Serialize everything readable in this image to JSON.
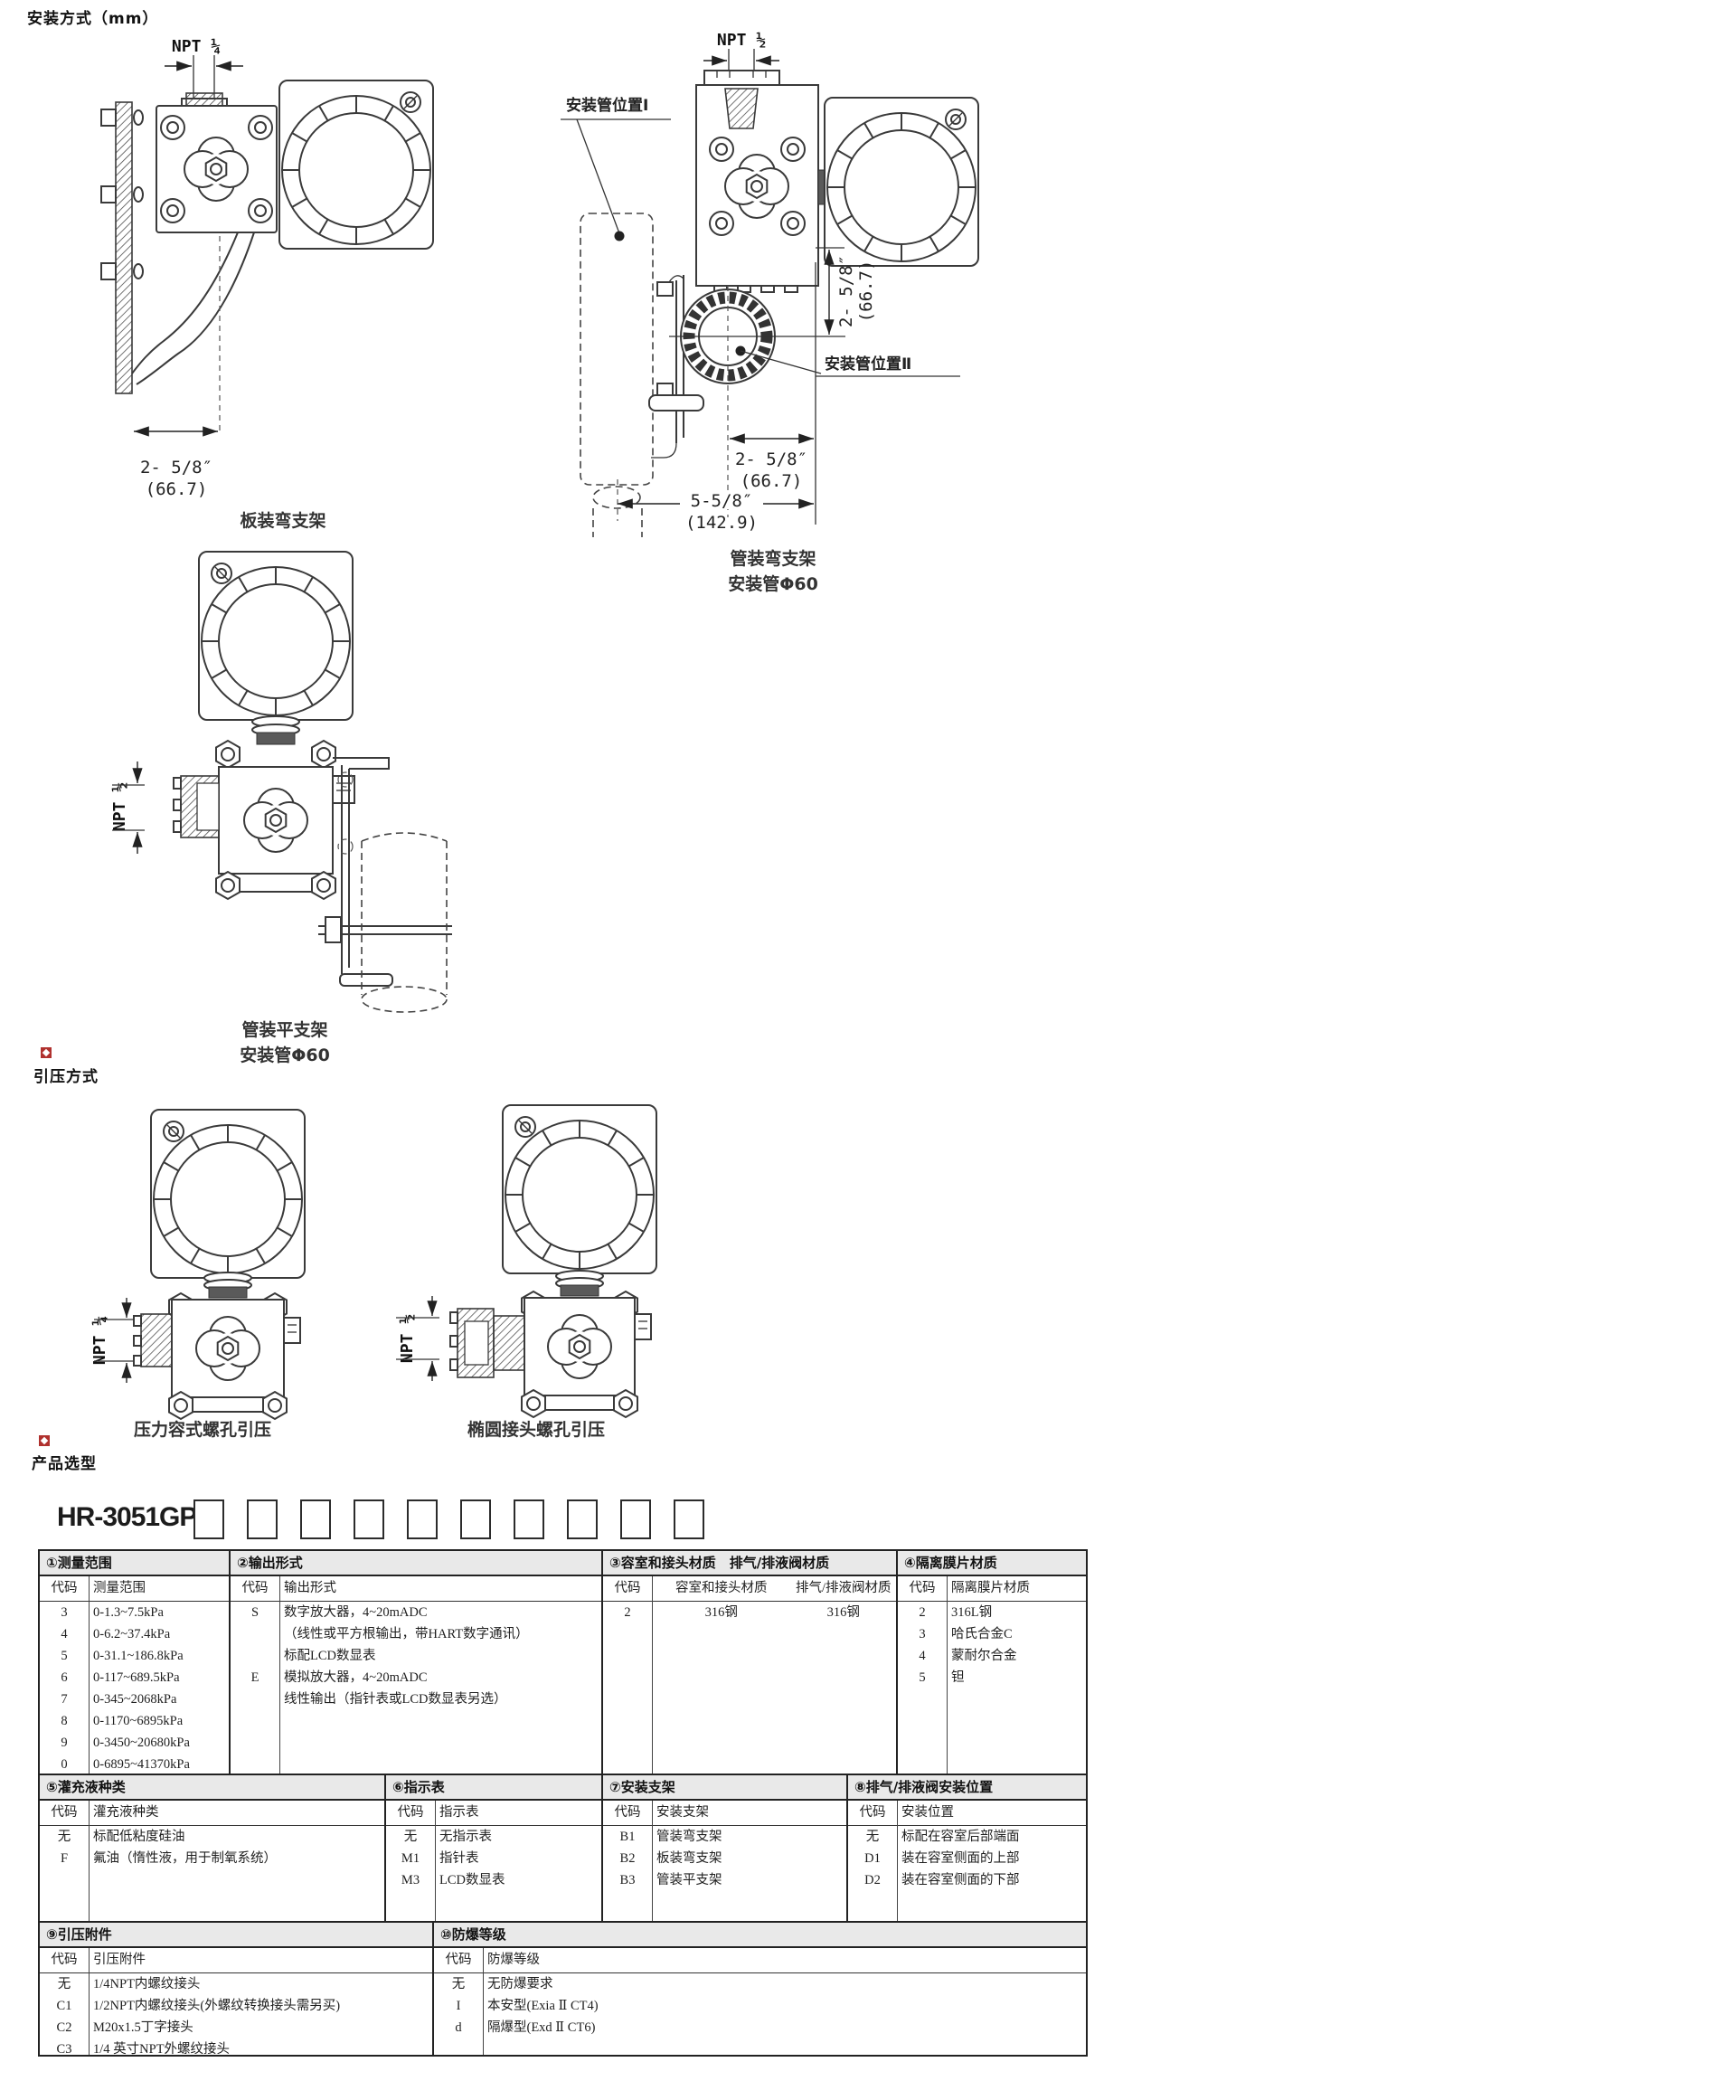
{
  "page": {
    "section1_title": "安装方式（mm）",
    "section2_title": "引压方式",
    "section3_title": "产品选型",
    "accent_red": "#b0312e",
    "line_color": "#3a3a3a"
  },
  "diagram_panel_bracket": {
    "npt": "NPT ¼",
    "dim_in": "2- 5/8″",
    "dim_mm": "(66.7)",
    "caption": "板装弯支架"
  },
  "diagram_pipe_bent": {
    "npt": "NPT ½",
    "pos1": "安装管位置Ⅰ",
    "pos2": "安装管位置Ⅱ",
    "vdim_in": "2- 5/8″",
    "vdim_mm": "(66.7)",
    "hdim1_in": "2- 5/8″",
    "hdim1_mm": "(66.7)",
    "hdim2_in": "5-5/8″",
    "hdim2_mm": "(142.9)",
    "caption1": "管装弯支架",
    "caption2": "安装管Φ60"
  },
  "diagram_pipe_flat": {
    "npt": "NPT ½",
    "caption1": "管装平支架",
    "caption2": "安装管Φ60"
  },
  "diagram_tap_left": {
    "npt": "NPT ¼",
    "caption": "压力容式螺孔引压"
  },
  "diagram_tap_right": {
    "npt": "NPT ½",
    "caption": "椭圆接头螺孔引压"
  },
  "selection": {
    "model_prefix": "HR-3051GP-",
    "positions": [
      "①",
      "②",
      "③",
      "④",
      "⑤",
      "⑥",
      "⑦",
      "⑧",
      "⑨",
      "⑩"
    ]
  },
  "tables": [
    {
      "title": "①测量范围",
      "headers": [
        "代码",
        "测量范围"
      ],
      "rows": [
        [
          "3",
          "0-1.3~7.5kPa"
        ],
        [
          "4",
          "0-6.2~37.4kPa"
        ],
        [
          "5",
          "0-31.1~186.8kPa"
        ],
        [
          "6",
          "0-117~689.5kPa"
        ],
        [
          "7",
          "0-345~2068kPa"
        ],
        [
          "8",
          "0-1170~6895kPa"
        ],
        [
          "9",
          "0-3450~20680kPa"
        ],
        [
          "0",
          "0-6895~41370kPa"
        ]
      ]
    },
    {
      "title": "②输出形式",
      "headers": [
        "代码",
        "输出形式"
      ],
      "rows": [
        [
          "S",
          "数字放大器，4~20mADC"
        ],
        [
          "",
          "（线性或平方根输出，带HART数字通讯）"
        ],
        [
          "",
          "标配LCD数显表"
        ],
        [
          "E",
          "模拟放大器，4~20mADC"
        ],
        [
          "",
          "线性输出（指针表或LCD数显表另选）"
        ]
      ]
    },
    {
      "title": "③容室和接头材质　排气/排液阀材质",
      "headers": [
        "代码",
        "容室和接头材质",
        "排气/排液阀材质"
      ],
      "rows": [
        [
          "2",
          "316钢",
          "316钢"
        ]
      ]
    },
    {
      "title": "④隔离膜片材质",
      "headers": [
        "代码",
        "隔离膜片材质"
      ],
      "rows": [
        [
          "2",
          "316L钢"
        ],
        [
          "3",
          "哈氏合金C"
        ],
        [
          "4",
          "蒙耐尔合金"
        ],
        [
          "5",
          "钽"
        ]
      ]
    },
    {
      "title": "⑤灌充液种类",
      "headers": [
        "代码",
        "灌充液种类"
      ],
      "rows": [
        [
          "无",
          "标配低粘度硅油"
        ],
        [
          "F",
          "氟油（惰性液，用于制氧系统）"
        ]
      ]
    },
    {
      "title": "⑥指示表",
      "headers": [
        "代码",
        "指示表"
      ],
      "rows": [
        [
          "无",
          "无指示表"
        ],
        [
          "M1",
          "指针表"
        ],
        [
          "M3",
          "LCD数显表"
        ]
      ]
    },
    {
      "title": "⑦安装支架",
      "headers": [
        "代码",
        "安装支架"
      ],
      "rows": [
        [
          "B1",
          "管装弯支架"
        ],
        [
          "B2",
          "板装弯支架"
        ],
        [
          "B3",
          "管装平支架"
        ]
      ]
    },
    {
      "title": "⑧排气/排液阀安装位置",
      "headers": [
        "代码",
        "安装位置"
      ],
      "rows": [
        [
          "无",
          "标配在容室后部端面"
        ],
        [
          "D1",
          "装在容室侧面的上部"
        ],
        [
          "D2",
          "装在容室侧面的下部"
        ]
      ]
    },
    {
      "title": "⑨引压附件",
      "headers": [
        "代码",
        "引压附件"
      ],
      "rows": [
        [
          "无",
          "1/4NPT内螺纹接头"
        ],
        [
          "C1",
          "1/2NPT内螺纹接头(外螺纹转换接头需另买)"
        ],
        [
          "C2",
          "M20x1.5丁字接头"
        ],
        [
          "C3",
          "1/4 英寸NPT外螺纹接头"
        ]
      ]
    },
    {
      "title": "⑩防爆等级",
      "headers": [
        "代码",
        "防爆等级"
      ],
      "rows": [
        [
          "无",
          "无防爆要求"
        ],
        [
          "I",
          "本安型(Exia Ⅱ CT4)"
        ],
        [
          "d",
          "隔爆型(Exd Ⅱ CT6)"
        ]
      ]
    }
  ]
}
